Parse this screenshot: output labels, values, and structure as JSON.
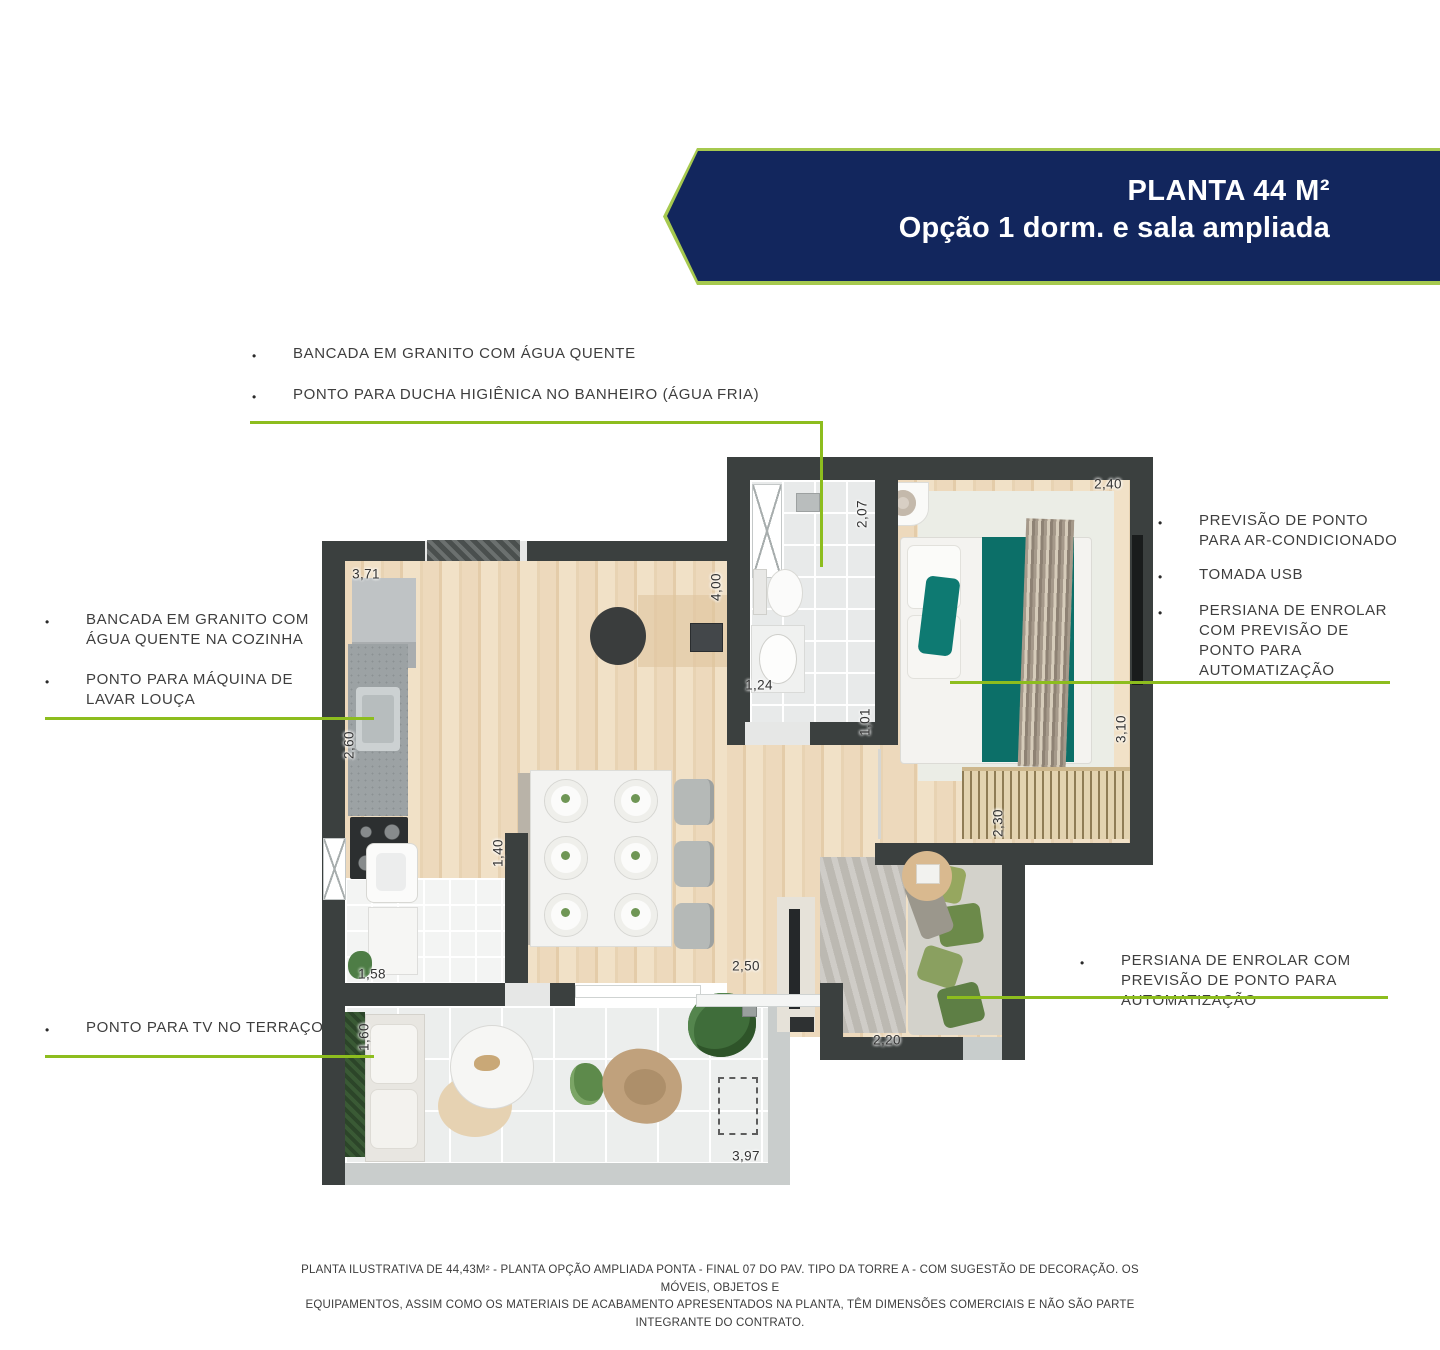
{
  "banner": {
    "title": "PLANTA 44 M²",
    "subtitle": "Opção 1 dorm. e sala ampliada"
  },
  "callouts": {
    "bullet": "•",
    "top": {
      "items": [
        "BANCADA EM GRANITO COM ÁGUA QUENTE",
        "PONTO PARA DUCHA HIGIÊNICA NO BANHEIRO (ÁGUA FRIA)"
      ]
    },
    "left": {
      "items": [
        "BANCADA EM GRANITO COM ÁGUA QUENTE NA COZINHA",
        "PONTO PARA MÁQUINA DE LAVAR LOUÇA"
      ]
    },
    "right": {
      "items": [
        "PREVISÃO DE PONTO PARA AR-CONDICIONADO",
        "TOMADA USB",
        "PERSIANA DE ENROLAR COM PREVISÃO DE PONTO PARA AUTOMATIZAÇÃO"
      ]
    },
    "bottom_right": {
      "items": [
        "PERSIANA DE ENROLAR COM PREVISÃO DE PONTO PARA AUTOMATIZAÇÃO"
      ]
    },
    "bottom_left": {
      "items": [
        "PONTO PARA TV NO TERRAÇO"
      ]
    }
  },
  "plan": {
    "dimensions": [
      {
        "id": "kitchen-top-width",
        "value": "3,71"
      },
      {
        "id": "kitchen-counter-depth",
        "value": "2,60"
      },
      {
        "id": "laundry-width",
        "value": "1,58"
      },
      {
        "id": "laundry-opening",
        "value": "1,40"
      },
      {
        "id": "living-depth",
        "value": "4,00"
      },
      {
        "id": "bathroom-depth",
        "value": "2,07"
      },
      {
        "id": "bathroom-width",
        "value": "1,24"
      },
      {
        "id": "bedroom-door-width",
        "value": "1,01"
      },
      {
        "id": "bedroom-width",
        "value": "2,40"
      },
      {
        "id": "bedroom-depth",
        "value": "3,10"
      },
      {
        "id": "sofa-nook-depth",
        "value": "2,30"
      },
      {
        "id": "sofa-nook-width",
        "value": "2,20"
      },
      {
        "id": "terrace-door-width",
        "value": "2,50"
      },
      {
        "id": "terrace-depth",
        "value": "1,60"
      },
      {
        "id": "terrace-width",
        "value": "3,97"
      }
    ]
  },
  "disclaimer": {
    "line1": "PLANTA ILUSTRATIVA DE 44,43M² - PLANTA OPÇÃO AMPLIADA PONTA - FINAL 07 DO PAV. TIPO DA TORRE A - COM SUGESTÃO DE DECORAÇÃO. OS MÓVEIS, OBJETOS E",
    "line2": "EQUIPAMENTOS, ASSIM COMO OS MATERIAIS DE ACABAMENTO APRESENTADOS NA PLANTA, TÊM DIMENSÕES COMERCIAIS E NÃO SÃO PARTE INTEGRANTE DO CONTRATO."
  },
  "colors": {
    "accent_green": "#8dbd1e",
    "banner_navy": "#12265d",
    "banner_border_green": "#a6c94f",
    "wall": "#3b403f",
    "wood_floor": "#e9d5b8",
    "bed_teal": "#0c6f68"
  }
}
